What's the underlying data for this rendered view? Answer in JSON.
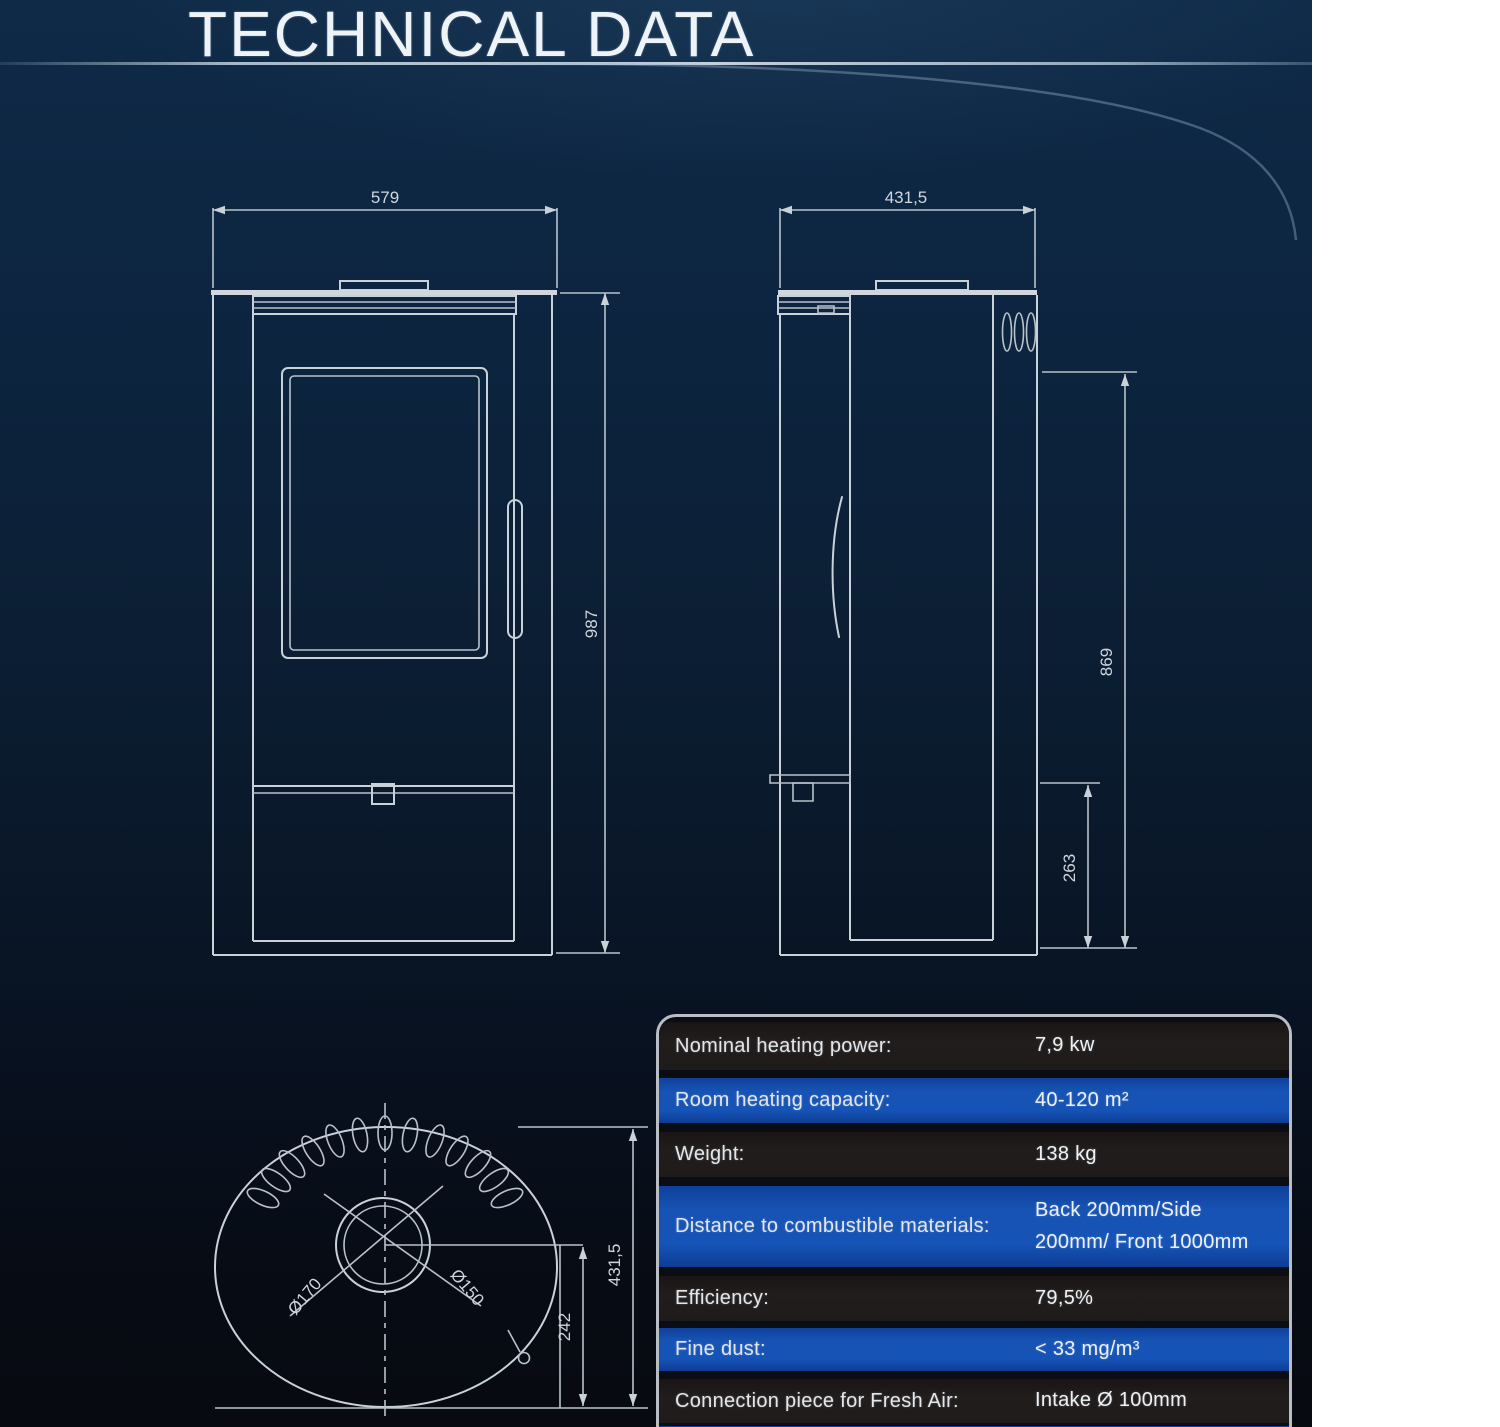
{
  "page": {
    "title": "TECHNICAL DATA"
  },
  "drawings": {
    "front_view": {
      "width_mm": "579",
      "height_mm": "987"
    },
    "side_view": {
      "depth_mm": "431,5",
      "flue_height_mm": "869",
      "lower_height_mm": "263"
    },
    "top_view": {
      "flue_outer_dia": "Ø170",
      "flue_inner_dia": "Ø150",
      "flue_offset_mm": "242",
      "depth_mm": "431,5"
    }
  },
  "spec_table": {
    "rows": [
      {
        "label": "Nominal heating power:",
        "value": "7,9 kw"
      },
      {
        "label": "Room heating capacity:",
        "value": "40-120 m²"
      },
      {
        "label": "Weight:",
        "value": "138 kg"
      },
      {
        "label": "Distance to combustible materials:",
        "value": "Back 200mm/Side 200mm/ Front 1000mm"
      },
      {
        "label": "Efficiency:",
        "value": "79,5%"
      },
      {
        "label": "Fine dust:",
        "value": "< 33 mg/m³"
      },
      {
        "label": "Connection piece for Fresh Air:",
        "value": "Intake Ø 100mm"
      }
    ]
  },
  "colors": {
    "accent_blue": "#1553b6",
    "row_dark": "#1e1b1a",
    "panel_navy": "#0c2139",
    "line": "#c9d1d9"
  }
}
